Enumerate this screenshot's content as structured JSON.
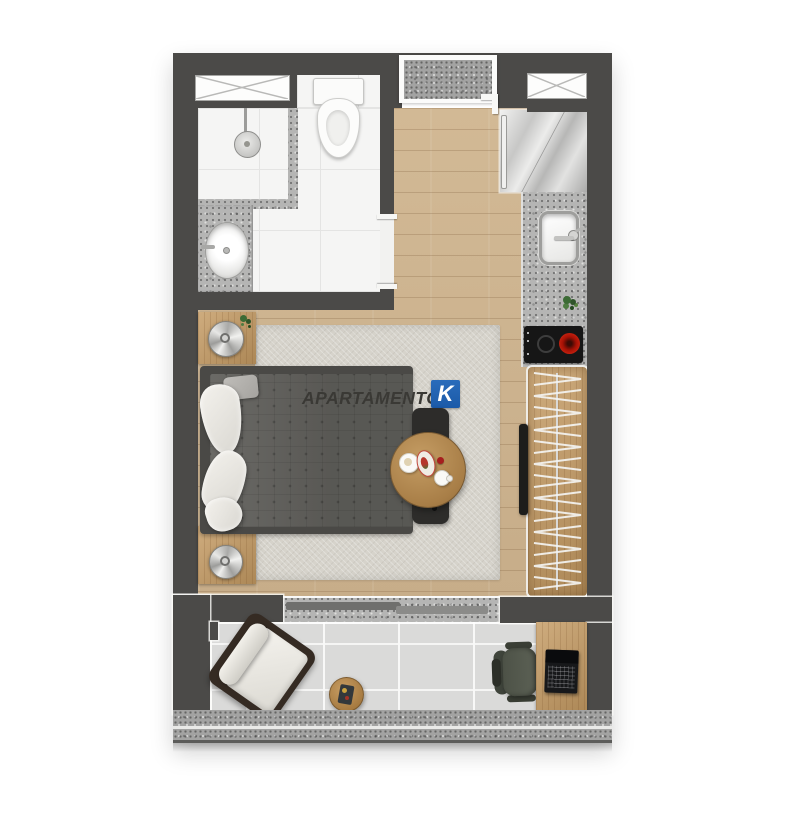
{
  "brand": {
    "name": "APARTAMENTO",
    "mark": "K"
  },
  "colors": {
    "wall": "#4b4a48",
    "accent-blue": "#1b5aa8",
    "wood-floor": "#ccb290",
    "furniture-wood": "#c49a62",
    "tile": "#f5f5f4",
    "granite": "#b5b5b4",
    "granite-dark": "#a3a3a2",
    "rug": "#d6d3cb",
    "duvet": "#5e5d59",
    "balcony-tile": "#dadad9",
    "cushion-white": "#efede7",
    "dark-frame": "#352b23",
    "burner-red": "#c2200e",
    "chair-olive": "#4d5247"
  },
  "rooms": [
    {
      "id": "bathroom",
      "features": [
        "window",
        "shower",
        "shower-head",
        "toilet",
        "vanity-sink",
        "door-opening"
      ]
    },
    {
      "id": "kitchen-hall",
      "features": [
        "entry-door",
        "window",
        "fridge",
        "granite-counter",
        "kitchen-sink",
        "cooktop",
        "herb-plant"
      ]
    },
    {
      "id": "bedroom-living",
      "features": [
        "area-rug",
        "double-bed",
        "pillows",
        "nightstand-top",
        "nightstand-bottom",
        "table-lamps",
        "round-dining-table",
        "foot-bench",
        "clothes-rack",
        "tv"
      ]
    },
    {
      "id": "balcony",
      "features": [
        "sliding-door",
        "lounge-chair",
        "side-table",
        "desk",
        "office-chair",
        "laptop",
        "parapet"
      ]
    }
  ]
}
